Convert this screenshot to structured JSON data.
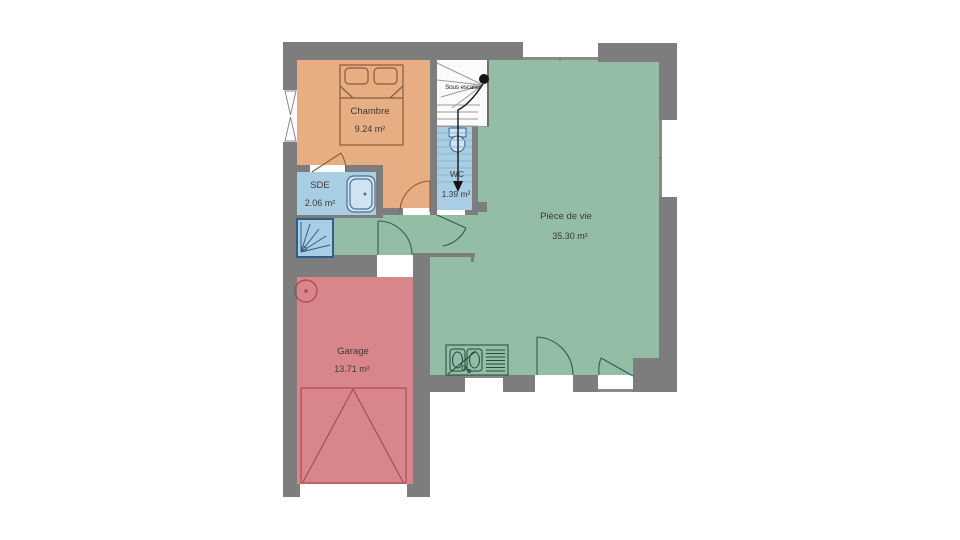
{
  "plan": {
    "title_hint": "floor-plan",
    "rooms": [
      {
        "id": "chambre",
        "name": "Chambre",
        "area": "9.24 m²",
        "color": "#e6ae82"
      },
      {
        "id": "sde",
        "name": "SDE",
        "area": "2.06 m²",
        "color": "#a9cde2"
      },
      {
        "id": "wc",
        "name": "WC",
        "area": "1.39 m²",
        "color": "#a9cde2"
      },
      {
        "id": "piece_de_vie",
        "name": "Pièce de vie",
        "area": "35.30 m²",
        "color": "#93bda5"
      },
      {
        "id": "garage",
        "name": "Garage",
        "area": "13.71 m²",
        "color": "#d8868b"
      }
    ],
    "annotations": {
      "under_stairs": "Sous escalier"
    },
    "colors": {
      "wall": "#7d7d7d",
      "background": "#ffffff",
      "fixture_blue": "#cfe3f2",
      "stairs_floor": "#fbfbfb"
    }
  }
}
